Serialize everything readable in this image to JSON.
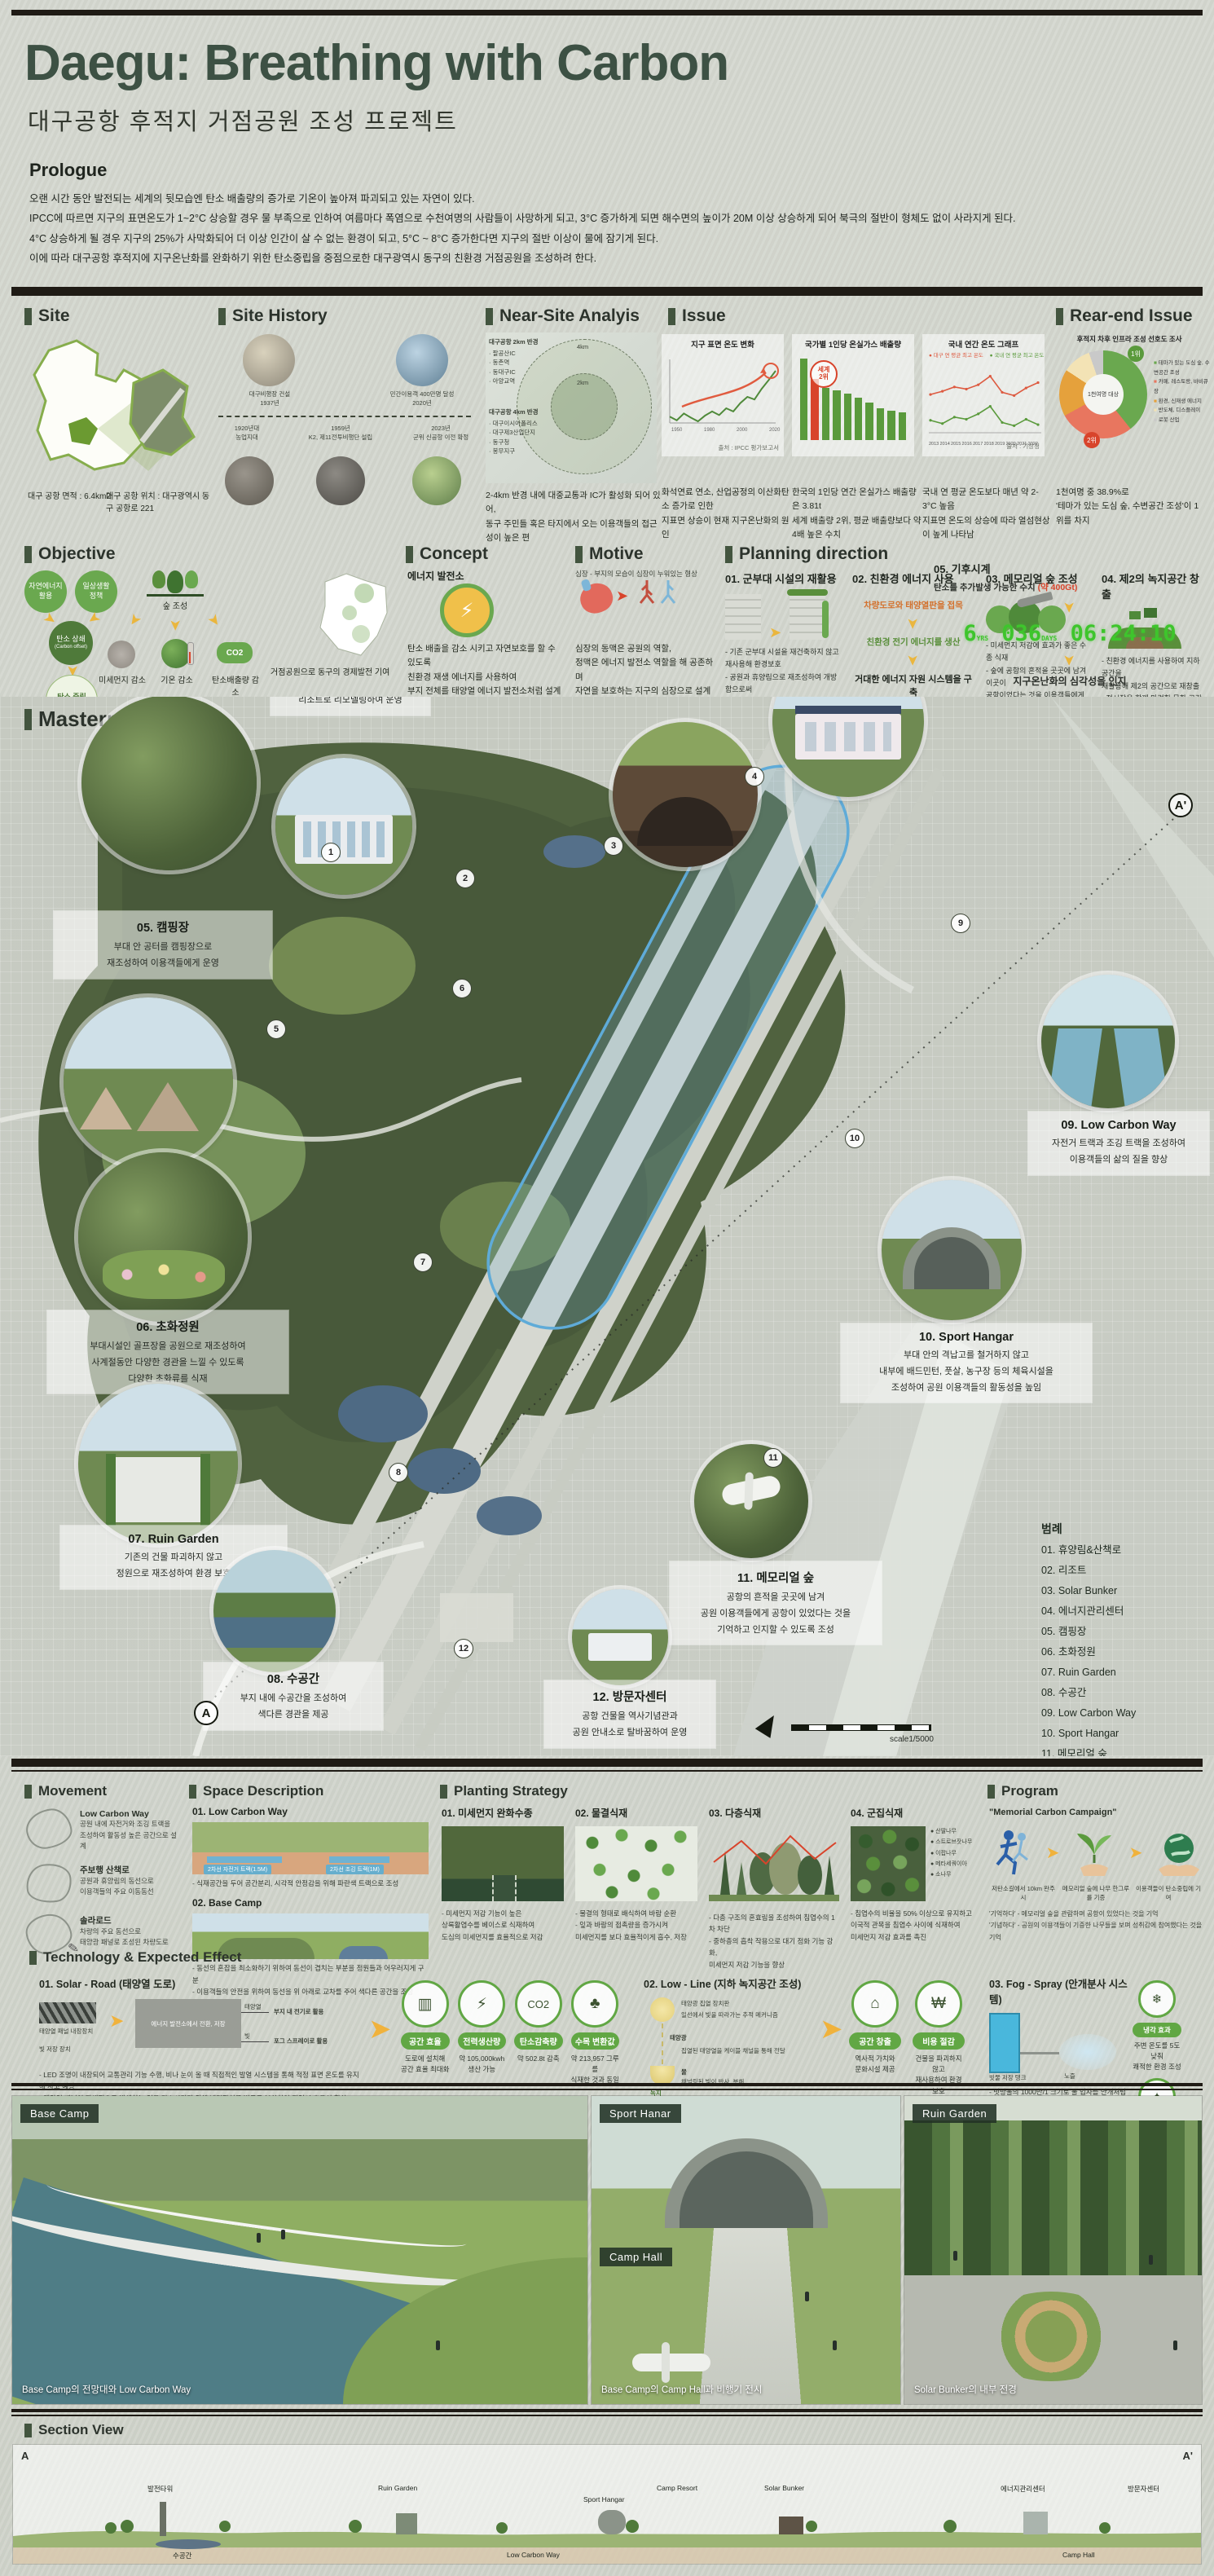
{
  "poster": {
    "header": {
      "title": "Daegu: Breathing with Carbon",
      "subtitle": "대구공항 후적지 거점공원 조성 프로젝트"
    },
    "prologue": {
      "heading": "Prologue",
      "body": "오랜 시간 동안 발전되는 세계의 뒷모습엔 탄소 배출량의 증가로 기온이 높아져 파괴되고 있는 자연이 있다.\nIPCC에 따르면 지구의 표면온도가 1~2°C 상승할 경우 물 부족으로 인하여 여름마다 폭염으로 수천여명의 사람들이 사망하게 되고, 3°C 증가하게 되면 해수면의 높이가 20M 이상 상승하게 되어 북극의 절반이 형체도 없이 사라지게 된다.\n4°C 상승하게 될 경우 지구의 25%가 사막화되어 더 이상 인간이 살 수 없는 환경이 되고, 5°C ~ 8°C 증가한다면 지구의 절반 이상이 물에 잠기게 된다.\n이에 따라 대구공항 후적지에 지구온난화를 완화하기 위한 탄소중립을 중점으로한 대구광역시 동구의 친환경 거점공원을 조성하려 한다."
    },
    "site": {
      "heading": "Site",
      "area": "대구 공항 면적 : 6.4km2",
      "location": "대구 공항 위치 : 대구광역시 동구 공항로 221"
    },
    "history": {
      "heading": "Site History",
      "above1_label": "대구비행장 건설",
      "above1_year": "1937년",
      "above2_label": "민간이용객 400만명 달성",
      "above2_year": "2020년",
      "below1_year": "1920년대",
      "below1_label": "농업지대",
      "below2_year": "1959년",
      "below2_label": "K2, 제11전투비행단 설립",
      "below3_year": "2023년",
      "below3_label": "군위 신공항 이전 확정"
    },
    "near": {
      "heading": "Near-Site Analyis",
      "ring_outer": "4km",
      "ring_inner": "2km",
      "group1_title": "대구공항 2km 반경",
      "group1_items": "· 팔공산IC\n· 동촌역\n· 동대구IC\n· 아양교역",
      "group2_title": "대구공항 4km 반경",
      "group2_items": "· 대구이시아폴리스\n· 대구제3산업단지\n· 동구청\n· 봉무지구",
      "caption": "2-4km 반경 내에 대중교통과 IC가 활성화 되어 있어,\n동구 주민들 혹은 타지에서 오는 이용객들의 접근성이 높은 편"
    },
    "issue": {
      "heading": "Issue",
      "c1": {
        "title": "지구 표면 온도 변화",
        "caption": "화석연료 연소, 산업공정의 이산화탄소 증가로 인한\n지표면 상승이 현재 지구온난화의 원인",
        "source": "출처 : IPCC 평가보고서",
        "chart": {
          "type": "line",
          "xticks": [
            "1950",
            "1980",
            "2000",
            "2020"
          ],
          "values": [
            0.02,
            -0.05,
            0.08,
            0.0,
            -0.07,
            0.04,
            0.12,
            0.05,
            0.18,
            0.12,
            0.28,
            0.4,
            0.35,
            0.55,
            0.72,
            0.9
          ]
        }
      },
      "c2": {
        "title": "국가별 1인당 온실가스 배출량",
        "badge": "세계\n2위",
        "caption": "한국의 1인당 연간 온실가스 배출량은 3.81t\n세계 배출량 2위, 평균 배출량보다 약 4배 높은 수치",
        "chart": {
          "type": "bar",
          "highlight_index": 1,
          "values": [
            5.6,
            4.2,
            3.6,
            3.4,
            3.2,
            2.9,
            2.6,
            2.2,
            2.0,
            1.9
          ]
        }
      },
      "c3": {
        "title": "국내 연간 온도 그래프",
        "legend1": "대구 연 평균 최고 온도",
        "legend2": "국내 연 평균 최고 온도",
        "caption": "국내 연 평균 온도보다 매년 약 2-3°C 높음\n지표면 온도의 상승에 따라 열섬현상이 높게 나타남",
        "source": "출처 : 기상청",
        "chart": {
          "type": "line-multi",
          "years": [
            "2013",
            "2014",
            "2015",
            "2016",
            "2017",
            "2018",
            "2019",
            "2020",
            "2021",
            "2022"
          ],
          "daegu": [
            30.1,
            30.4,
            30.8,
            30.6,
            31.0,
            31.8,
            30.3,
            30.0,
            30.7,
            31.2
          ],
          "national": [
            27.7,
            27.4,
            28.0,
            27.8,
            28.3,
            29.0,
            27.5,
            27.2,
            27.8,
            27.3
          ]
        }
      }
    },
    "rear": {
      "heading": "Rear-end Issue",
      "donut_title": "후적지 차후 인프라 조성 선호도 조사",
      "center": "1천여명 대상",
      "rank1": "1위",
      "rank2": "2위",
      "caption": "1천여명 중 38.9%로\n'테마가 있는 도심 숲, 수변공간 조성'이 1위를 차지",
      "chart": {
        "type": "pie",
        "slices": [
          {
            "label": "테마가 있는 도심 숲, 수변공간 조성",
            "pct": 38.9,
            "color": "#6aa84f"
          },
          {
            "label": "카페, 레스토랑, 바비큐장",
            "pct": 27.4,
            "color": "#e8765f"
          },
          {
            "label": "환경, 신재생 에너지",
            "pct": 17.1,
            "color": "#e5a13c"
          },
          {
            "label": "반도체, 디스플레이",
            "pct": 10.4,
            "color": "#f3e3b5"
          },
          {
            "label": "로봇 산업",
            "pct": 5.2,
            "color": "#c9c9c9"
          }
        ]
      }
    },
    "objective": {
      "heading": "Objective",
      "n1": "자연에너지\n활용",
      "n2": "일상생활\n정책",
      "n3": "탄소 상쇄",
      "n3sub": "(Carbon offset)",
      "n4": "탄소 중립",
      "n4sub": "실질적 탄소 배출량 ↓",
      "tree": "숲 조성",
      "b1": "미세먼지 감소",
      "b2": "기온 감소",
      "b3": "탄소배출량 감소",
      "map_caption": "거점공원으로 동구의 경제발전 기여"
    },
    "concept": {
      "heading": "Concept",
      "sub": "에너지 발전소",
      "body": "탄소 배출을 감소 시키고 자연보호를 할 수 있도록\n친환경 재생 에너지를 사용하여\n부지 전체를 태양열 에너지 발전소처럼 설계"
    },
    "motive": {
      "heading": "Motive",
      "sub": "심장 - 부지의 모습이 심장이 누워있는 형상",
      "body": "심장의 동맥은 공원의 역할,\n정맥은 에너지 발전소 역할을 해 공존하며\n자연을 보호하는 지구의 심장으로 설계"
    },
    "planning": {
      "heading": "Planning direction",
      "p1_t": "01. 군부대 시설의 재활용",
      "p1_b": "- 기존 군부대 시설을 재건축하지 않고 재사용해 환경보호\n- 공원과 휴양림으로 재조성하여 개방함으로써\n이용객들에게 이색의 휴식을 제공",
      "p2_t": "02. 친환경 에너지 사용",
      "p2_s1": "차량도로와 태양열판을 접목",
      "p2_s2": "친환경 전기 에너지를 생산",
      "p2_s3": "거대한 에너지 자원 시스템을 구축",
      "p3_t": "03. 메모리얼 숲 조성",
      "p3_b": "- 미세먼지 저감에 효과가 좋은 수종 식재\n- 숲에 공항의 흔적을 곳곳에 남겨 이곳이\n공항이었다는 것을 이용객들에게 인지, 기억",
      "p4_t": "04. 제2의 녹지공간 창출",
      "p4_b": "- 친환경 에너지를 사용하여 지하공간을\n재활용해 제2의 공간으로 재창출\n- 전시장을 함께 마련한 문화 공간 제공",
      "p5_t": "05. 기후시계",
      "p5_top": "탄소를 추가발생 가능한 수치",
      "p5_top_red": "(약 400Gt)",
      "clock_y": "6",
      "clock_yu": "YRS",
      "clock_d": "036",
      "clock_du": "DAYS",
      "clock_t": "06:24:10",
      "p5_bottom": "지구온난화의 심각성을 인지"
    },
    "masterplan": {
      "heading": "Masterplan",
      "callouts": [
        {
          "title": "01. 휴양림&산책로",
          "body": "기존에 있는 산지에 산책로를 만들어\n포그 스프레이 기술로 기온저감의 효과와\n여름철에도 시원한 산책을 할 수 있도록 조성"
        },
        {
          "title": "02. 리조트",
          "body": "생활관으로 사용하던 공간을\n리조트로 리모델링하여 운영"
        },
        {
          "title": "03. Solar Bunker",
          "body": "방공호를 지하 녹지공간으로\n조성하여 전시문화공간을 제공"
        },
        {
          "title": "04. 에너지관리센터",
          "body": "부지 내의 친환경 에너지를\n관리, 연구하고 저장"
        },
        {
          "title": "05. 캠핑장",
          "body": "부대 안 공터를 캠핑장으로\n재조성하여 이용객들에게 운영"
        },
        {
          "title": "06. 초화정원",
          "body": "부대시설인 골프장을 공원으로 재조성하여\n사계절동안 다양한 경관을 느낄 수 있도록\n다양한 초화류를 식재"
        },
        {
          "title": "07. Ruin Garden",
          "body": "기존의 건물 파괴하지 않고\n정원으로 재조성하여 환경 보호"
        },
        {
          "title": "08. 수공간",
          "body": "부지 내에 수공간을 조성하여\n색다른 경관을 제공"
        },
        {
          "title": "09. Low Carbon Way",
          "body": "자전거 트랙과 조깅 트랙을 조성하여\n이용객들의 삶의 질을 향상"
        },
        {
          "title": "10. Sport Hangar",
          "body": "부대 안의 격납고를 철거하지 않고\n내부에 배드민턴, 풋살, 농구장 등의 체육시설을\n조성하여 공원 이용객들의 활동성을 높임"
        },
        {
          "title": "11. 메모리얼 숲",
          "body": "공항의 흔적을 곳곳에 남겨\n공원 이용객들에게 공항이 있었다는 것을\n기억하고 인지할 수 있도록 조성"
        },
        {
          "title": "12. 방문자센터",
          "body": "공항 건물을 역사기념관과\n공원 안내소로 탈바꿈하여 운영"
        }
      ],
      "legend": {
        "title": "범례",
        "items": [
          "01. 휴양림&산책로",
          "02. 리조트",
          "03. Solar Bunker",
          "04. 에너지관리센터",
          "05. 캠핑장",
          "06. 초화정원",
          "07. Ruin Garden",
          "08. 수공간",
          "09. Low Carbon Way",
          "10. Sport Hangar",
          "11. 메모리얼 숲",
          "12. 방문자센터"
        ]
      },
      "scale": "scale1/5000",
      "markerA": "A",
      "markerA2": "A'",
      "dots": [
        {
          "n": "1",
          "x": 405,
          "y": 190
        },
        {
          "n": "2",
          "x": 570,
          "y": 222
        },
        {
          "n": "3",
          "x": 752,
          "y": 182
        },
        {
          "n": "4",
          "x": 925,
          "y": 97
        },
        {
          "n": "5",
          "x": 338,
          "y": 407
        },
        {
          "n": "6",
          "x": 566,
          "y": 357
        },
        {
          "n": "7",
          "x": 518,
          "y": 693
        },
        {
          "n": "8",
          "x": 488,
          "y": 951
        },
        {
          "n": "9",
          "x": 1178,
          "y": 277
        },
        {
          "n": "10",
          "x": 1048,
          "y": 541
        },
        {
          "n": "11",
          "x": 948,
          "y": 933
        },
        {
          "n": "12",
          "x": 568,
          "y": 1167
        }
      ]
    },
    "movement": {
      "heading": "Movement",
      "r1_name": "Low Carbon Way",
      "r1_body": "공원 내에 자전거와 조깅 트랙을\n조성하여 활동성 높은 공간으로 설계",
      "r2_name": "주보행 산책로",
      "r2_body": "공원과 휴양림의 동선으로\n이용객들의 주요 이동동선",
      "r3_name": "솔라로드",
      "r3_body": "차량의 주요 동선으로\n태양광 패널로 조성된 차량도로"
    },
    "space": {
      "heading": "Space Description",
      "i1_t": "01. Low Carbon Way",
      "i1_tag1": "2차선 자전거 트랙(1.5M)",
      "i1_tag2": "2차선 조깅 트랙(1M)",
      "i1_b": "- 식재공간을 두어 공간분리, 시각적 안정감을 위해 파란색 트랙으로 조성",
      "i2_t": "02. Base Camp",
      "i2_b": "- 동선의 혼잡을 최소화하기 위하여 동선이 겹치는 부분을 정원들과 어우러지게 구분\n- 이용객들의 안전을 위하여 동선을 위 아래로 교차를 주어 색다른 공간을 조성"
    },
    "planting": {
      "heading": "Planting Strategy",
      "p1_t": "01. 미세먼지 완화수종",
      "p1_b": "- 미세먼지 저감 기능이 높은\n상록활엽수를 베이스로 식재하여\n도심의 미세먼지를 효율적으로 저감",
      "p2_t": "02. 물결식재",
      "p2_b": "- 물결의 형태로 배식하여 바람 순환\n- 잎과 바람의 접촉량을 증가시켜\n미세먼지를 보다 효율적이게 흡수, 저장",
      "p3_t": "03. 다층식재",
      "p3_b": "- 다층 구조의 혼효림을 조성하여 침엽수의 1차 차단\n- 중하층의 흡착 작용으로 대기 정화 기능 강화,\n미세먼지 저감 기능을 향상",
      "p4_t": "04. 군집식재",
      "p4_b": "- 침엽수의 비율을 50% 이상으로 유지하고\n이국적 관목을 침엽수 사이에 식재하여\n미세먼지 저감 효과를 촉진",
      "species": "● 산딸나무\n● 스트로브잣나무\n● 이팝나무\n● 메타세쿼이아\n● 소나무"
    },
    "program": {
      "heading": "Program",
      "sub": "\"Memorial Carbon Campaign\"",
      "s1": "저탄소길에서 10km 완주 시",
      "s2": "메모리얼 숲에 나무 한그루를 기증",
      "s3": "이용객들이 탄소중립에 기여",
      "q1": "'기억하다' - 메모리얼 숲을 관람하며 공항이 있었다는 것을 기억",
      "q2": "'기념하다' - 공원의 이용객들이 기증한 나무들을 보며 성취감에 참여했다는 것을 기억"
    },
    "tech": {
      "heading": "Technology & Expected Effect",
      "g1_t": "01. Solar - Road (태양열 도로)",
      "g1_lbl_panel": "태양열 패널 내장장치",
      "g1_lbl_store": "빛 저장 장치",
      "g1_lbl_plant": "에너지 발전소에서 전환, 저장",
      "g1_out1a": "태양열",
      "g1_out1b": "부지 내 전기로 활용",
      "g1_out2a": "빛",
      "g1_out2b": "포그 스프레이로 활용",
      "g1_bullets": "- LED 조명이 내장되어 교통관리 기능 수행, 비나 눈이 올 때 직접적인 발열 시스템을 통해 적정 표면 온도를 유지해 사고 예방\n- 태양열 패널이 자체적으로 발생하는 열을 감소시키기 위해 냉각장치를 별도로 부착하여 집열시 효율성 향상",
      "g1_badges": [
        {
          "label": "공간 효율",
          "value": "도로에 설치해\n공간 효율 최대화"
        },
        {
          "label": "전력생산량",
          "value": "약 105,000kwh\n생산 가능"
        },
        {
          "label": "탄소감축량",
          "value": "약 502.8t 감축"
        },
        {
          "label": "수목 변환값",
          "value": "약 213,957 그루를\n식재한 것과 동일"
        }
      ],
      "g2_t": "02. Low - Line (지하 녹지공간 조성)",
      "g2_l1": "태양광 집열 장치판",
      "g2_l2": "일선에서 빛을 따라가는 추적 메커니즘",
      "g2_w1": "태양광",
      "g2_l3": "집열된 태양열을 케이블 채널을 통해 전달",
      "g2_w2": "물",
      "g2_l4": "채널링된 빛이 반사, 분해",
      "g2_l5": "녹지",
      "g2_badges": [
        {
          "label": "공간 창출",
          "value": "역사적 가치와\n문화시설 제공"
        },
        {
          "label": "비용 절감",
          "value": "건물을 파괴하지 않고\n재사용하여 환경보호"
        }
      ],
      "g3_t": "03. Fog - Spray (안개분사 시스템)",
      "g3_l1": "빗물 저장 탱크",
      "g3_l2": "노즐",
      "g3_bullet": "- 빗방울의 1000만/1 크기로 물 입자를 안개처럼 분사하는 기술",
      "g3_badges": [
        {
          "label": "냉각 효과",
          "value": "주변 온도를 5도 낮춰\n쾌적한 환경 조성"
        },
        {
          "label": "먼지 제거",
          "value": "공기정화의 효과와\n호흡기 문제 완화"
        }
      ]
    },
    "renders": {
      "p1_tag": "Base Camp",
      "p1_cap": "Base Camp의 전망대와 Low Carbon Way",
      "p2_tag1": "Sport Hanar",
      "p2_tag2": "Camp Hall",
      "p2_cap": "Base Camp의 Camp Hall과 비행기 전시",
      "p3_tag": "Ruin Garden",
      "p3_cap": "Solar Bunker의 내부 전경"
    },
    "section": {
      "heading": "Section View",
      "a": "A",
      "a2": "A'",
      "top_labels": [
        "발전타워",
        "Ruin Garden",
        "Sport Hangar",
        "Camp Resort",
        "Solar Bunker",
        "에너지관리센터",
        "방문자센터"
      ],
      "bottom_labels": [
        "수공간",
        "Low Carbon Way",
        "Camp Hall"
      ]
    }
  }
}
